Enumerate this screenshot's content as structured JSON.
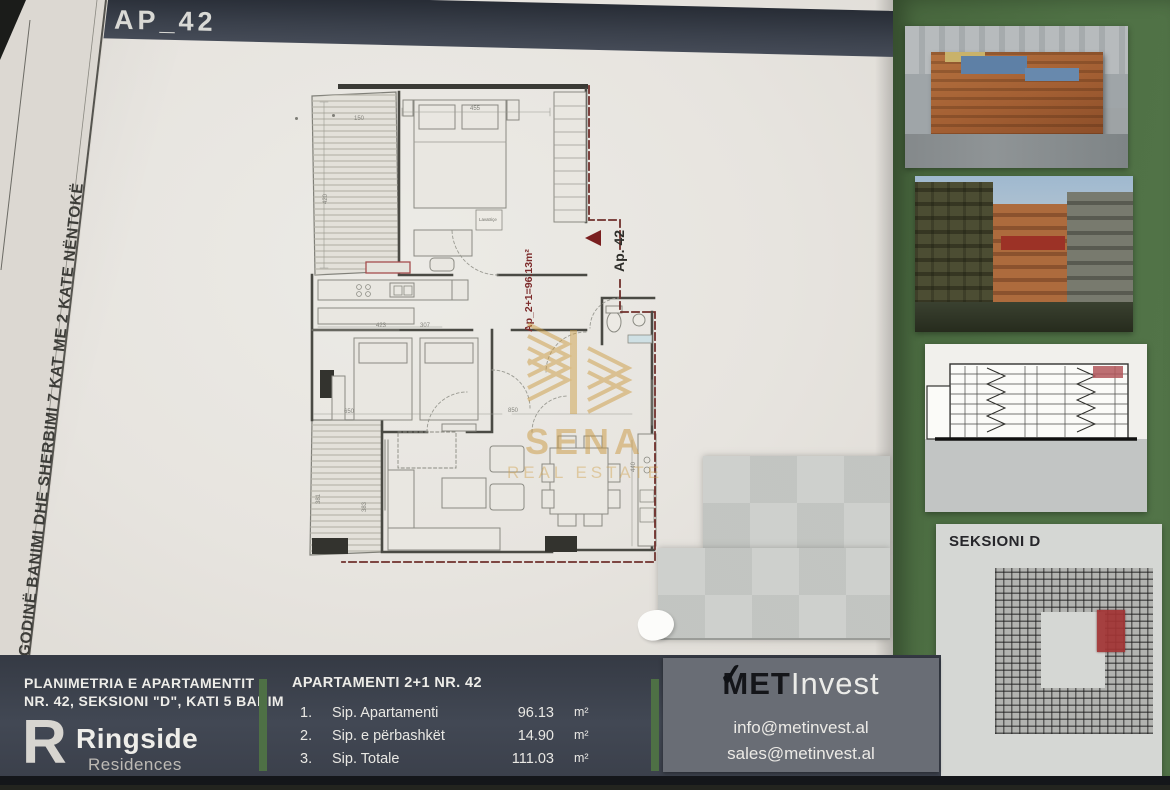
{
  "header": {
    "title": "AP_42"
  },
  "side_strip": {
    "text": "GODINË BANIMI DHE SHERBIMI 7 KAT ME 2 KATE NËNTOKË"
  },
  "plan": {
    "unit_label": "Ap. 42",
    "area_label": "Ap_2+1=96.13m²",
    "appliance_label": "Lavatriçe",
    "dims": [
      "150",
      "455",
      "423",
      "307",
      "650",
      "850",
      "383",
      "440",
      "420",
      "381"
    ]
  },
  "watermark": {
    "brand": "SENA",
    "tagline": "REAL ESTATE",
    "color": "#c9963c"
  },
  "right_panel": {
    "seksioni_title": "SEKSIONI D"
  },
  "footer": {
    "plan_title_line1": "PLANIMETRIA E APARTAMENTIT",
    "plan_title_line2": "NR. 42, SEKSIONI \"D\", KATI 5 BANIM",
    "developer": {
      "name": "Ringside",
      "sub": "Residences",
      "glyph": "R"
    },
    "apartment": {
      "title": "APARTAMENTI 2+1 NR. 42",
      "rows": [
        {
          "no": "1.",
          "label": "Sip. Apartamenti",
          "value": "96.13",
          "unit": "m²"
        },
        {
          "no": "2.",
          "label": "Sip. e përbashkët",
          "value": "14.90",
          "unit": "m²"
        },
        {
          "no": "3.",
          "label": "Sip. Totale",
          "value": "111.03",
          "unit": "m²"
        }
      ]
    },
    "agency": {
      "brand_bold": "MET",
      "brand_light": "Invest",
      "email_info": "info@metinvest.al",
      "email_sales": "sales@metinvest.al"
    }
  },
  "colors": {
    "bar": "#3d424d",
    "green": "#4e7045",
    "paper": "#e8e5e0",
    "accent_red": "#7a1f1f",
    "gold": "#c9963c"
  }
}
